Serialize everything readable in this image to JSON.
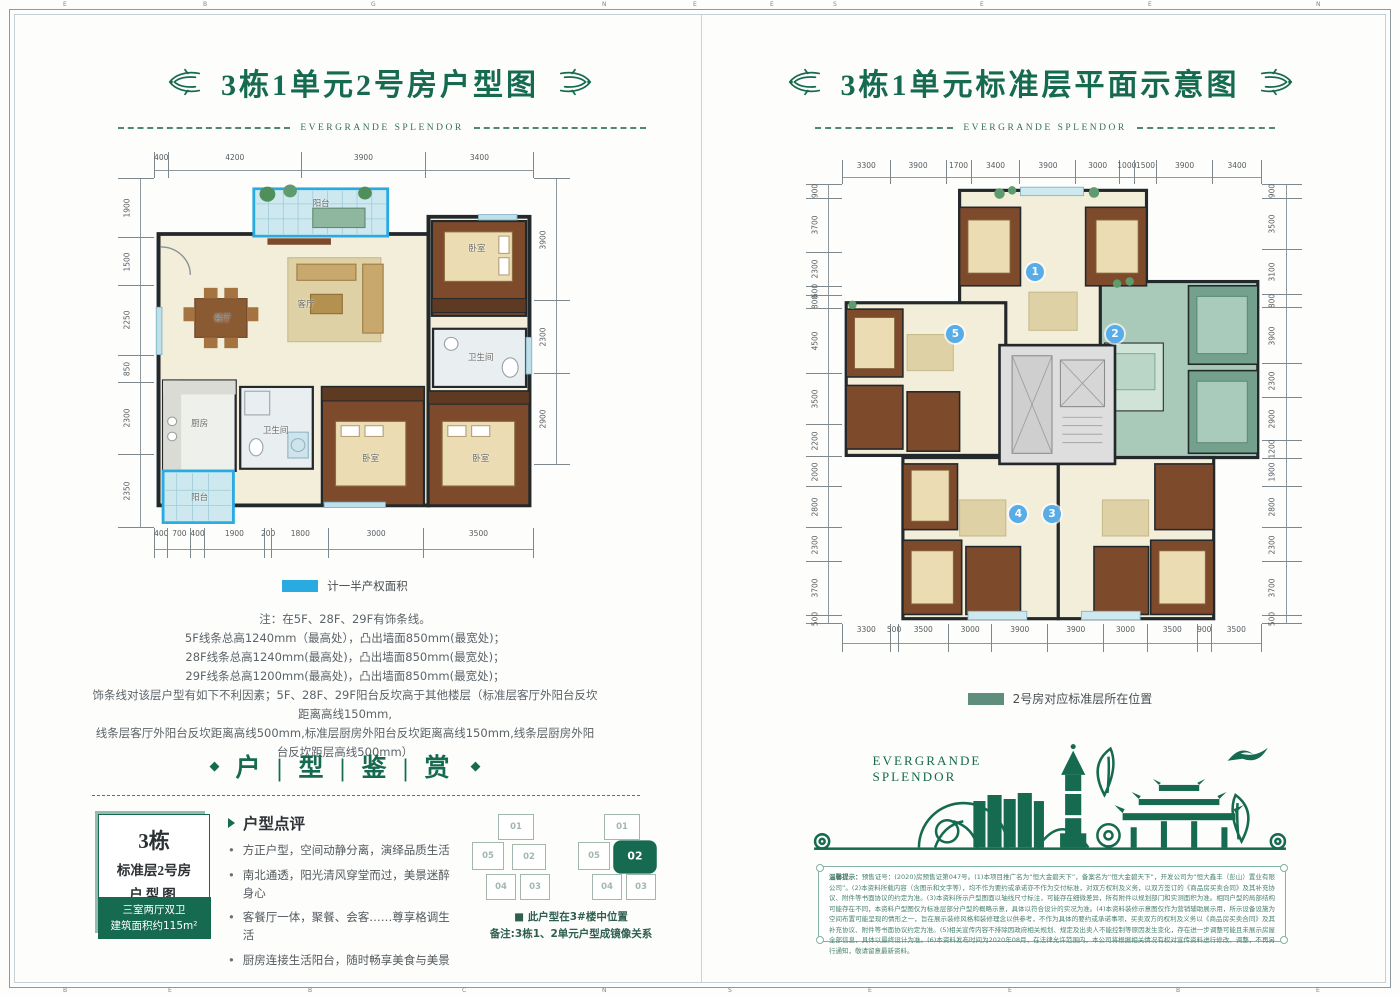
{
  "accent": "#156A50",
  "frame": {
    "top_letters": [
      {
        "ch": "E",
        "x": 4.5
      },
      {
        "ch": "B",
        "x": 14.5
      },
      {
        "ch": "G",
        "x": 26.5
      },
      {
        "ch": "N",
        "x": 43
      },
      {
        "ch": "E",
        "x": 49.5
      },
      {
        "ch": "E",
        "x": 55
      },
      {
        "ch": "S",
        "x": 59.5
      },
      {
        "ch": "E",
        "x": 70
      },
      {
        "ch": "E",
        "x": 82
      },
      {
        "ch": "N",
        "x": 94
      }
    ],
    "bottom_letters": [
      {
        "ch": "B",
        "x": 4.5
      },
      {
        "ch": "E",
        "x": 12
      },
      {
        "ch": "B",
        "x": 22
      },
      {
        "ch": "C",
        "x": 33
      },
      {
        "ch": "N",
        "x": 43
      },
      {
        "ch": "S",
        "x": 52
      },
      {
        "ch": "E",
        "x": 62
      },
      {
        "ch": "E",
        "x": 72
      },
      {
        "ch": "B",
        "x": 84
      },
      {
        "ch": "E",
        "x": 94
      }
    ]
  },
  "left_page": {
    "title": "3栋1单元2号房户型图",
    "brand_rule": "EVERGRANDE SPLENDOR",
    "plan": {
      "dims_top": [
        "400",
        "4200",
        "3900",
        "3400"
      ],
      "dims_bottom": [
        "400",
        "700",
        "400",
        "1900",
        "200",
        "1800",
        "3000",
        "3500"
      ],
      "dims_left": [
        "1900",
        "1500",
        "2250",
        "850",
        "2300",
        "2350"
      ],
      "dims_right": [
        "3900",
        "2300",
        "2900"
      ],
      "rooms": [
        {
          "label": "阳台",
          "x": 44,
          "y": 7
        },
        {
          "label": "卧室",
          "x": 85,
          "y": 20
        },
        {
          "label": "餐厅",
          "x": 18,
          "y": 40
        },
        {
          "label": "客厅",
          "x": 40,
          "y": 36
        },
        {
          "label": "卫生间",
          "x": 86,
          "y": 51
        },
        {
          "label": "厨房",
          "x": 12,
          "y": 70
        },
        {
          "label": "卫生间",
          "x": 32,
          "y": 72
        },
        {
          "label": "卧室",
          "x": 57,
          "y": 80
        },
        {
          "label": "卧室",
          "x": 86,
          "y": 80
        },
        {
          "label": "阳台",
          "x": 12,
          "y": 91
        }
      ]
    },
    "legend": {
      "label": "计一半产权面积",
      "color": "#29ABE2"
    },
    "notes": [
      "注：在5F、28F、29F有饰条线。",
      "5F线条总高1240mm（最高处），凸出墙面850mm(最宽处)；",
      "28F线条总高1240mm(最高处)，凸出墙面850mm(最宽处)；",
      "29F线条总高1200mm(最高处)，凸出墙面850mm(最宽处)；",
      "饰条线对该层户型有如下不利因素；5F、28F、29F阳台反坎高于其他楼层（标准层客厅外阳台反坎距离高线150mm,",
      "线条层客厅外阳台反坎距离高线500mm,标准层厨房外阳台反坎距离高线150mm,线条层厨房外阳台反坎距层高线500mm）"
    ],
    "section": {
      "title": "户 | 型 | 鉴 | 赏",
      "bullet": "◆"
    },
    "info_box": {
      "line1": "3栋",
      "line2": "标准层2号房",
      "line3": "户型图",
      "line4": "三室两厅双卫",
      "line5": "建筑面积约115m²"
    },
    "review": {
      "header": "户型点评",
      "bullets": [
        "方正户型，空间动静分离，演绎品质生活",
        "南北通透，阳光清风穿堂而过，美景迷醉身心",
        "客餐厅一体，聚餐、会客……尊享格调生活",
        "厨房连接生活阳台，随时畅享美食与美景"
      ]
    },
    "mini_plan": {
      "clusters": [
        {
          "units": [
            "01",
            "05",
            "02",
            "04",
            "03"
          ],
          "highlight": ""
        },
        {
          "units": [
            "01",
            "05",
            "02",
            "04",
            "03"
          ],
          "highlight": "02"
        }
      ],
      "caption1": "■ 此户型在3#楼中位置",
      "caption2": "备注:3栋1、2单元户型成镜像关系"
    }
  },
  "right_page": {
    "title": "3栋1单元标准层平面示意图",
    "brand_rule": "EVERGRANDE SPLENDOR",
    "plan": {
      "dims_top": [
        "3300",
        "3900",
        "1700",
        "3400",
        "3900",
        "3000",
        "1000",
        "1500",
        "3900",
        "3400"
      ],
      "dims_bottom": [
        "3300",
        "500",
        "3500",
        "3000",
        "3900",
        "3900",
        "3000",
        "3500",
        "900",
        "3500"
      ],
      "dims_left": [
        "900",
        "3700",
        "2300",
        "600",
        "800",
        "4500",
        "3500",
        "2200",
        "2000",
        "2800",
        "2300",
        "3700",
        "500"
      ],
      "dims_right": [
        "900",
        "3500",
        "3100",
        "800",
        "3900",
        "2300",
        "2900",
        "1200",
        "1900",
        "2800",
        "2300",
        "3700",
        "500"
      ],
      "units": [
        {
          "num": "1",
          "x": 46,
          "y": 20
        },
        {
          "num": "5",
          "x": 27,
          "y": 34
        },
        {
          "num": "2",
          "x": 65,
          "y": 34
        },
        {
          "num": "4",
          "x": 42,
          "y": 75
        },
        {
          "num": "3",
          "x": 50,
          "y": 75
        }
      ]
    },
    "legend": {
      "label": "2号房对应标准层所在位置",
      "color": "#5E8F7E"
    },
    "skyline": {
      "brand_line1": "EVERGRANDE",
      "brand_line2": "SPLENDOR"
    },
    "disclaimer": {
      "label": "温馨提示：",
      "text": "预售证号：(2020)房预售证第047号。(1)本项目推广名为“恒大金碧天下”，备案名为“恒大金碧天下”，开发公司为“恒大鑫丰（彭山）置业有限公司”。(2)本资料所载内容（含图示和文字等），均不作为要约或承诺亦不作为交付标准，对双方权利及义务，以双方签订的《商品房买卖合同》及其补充协议、附件等书面协议的约定为准。(3)本资料所示户型图面以轴线尺寸标注，可能存在细微差异，所有附件以规划部门和实测面积为准。相同户型的局部结构可能存在不同，本资料户型图仅为标准层部分户型的概略示意，具体以符合设计的实况为准。(4)本资料装修示意图仅作为营销辅助展示用，所示设备设施为空间布置可能呈现的情形之一，旨在展示装修风格和装修理念以供参考，不作为具体的要约或承诺事项，买卖双方的权利及义务以《商品房买卖合同》及其补充协议、附件等书面协议约定为准。(5)相关宣传内容不排除因政府相关规划、规定及出卖人不能控制等原因发生变化，存在进一步调整可能且未展示房屋全部信息，具体以最终设计为准。(6)本资料发布时间为2020年08月，在法律允许范围内，本公司将根据相关情况有权对宣传资料进行修改、调整，不再另行通知，敬请留意最新资料。"
    }
  }
}
